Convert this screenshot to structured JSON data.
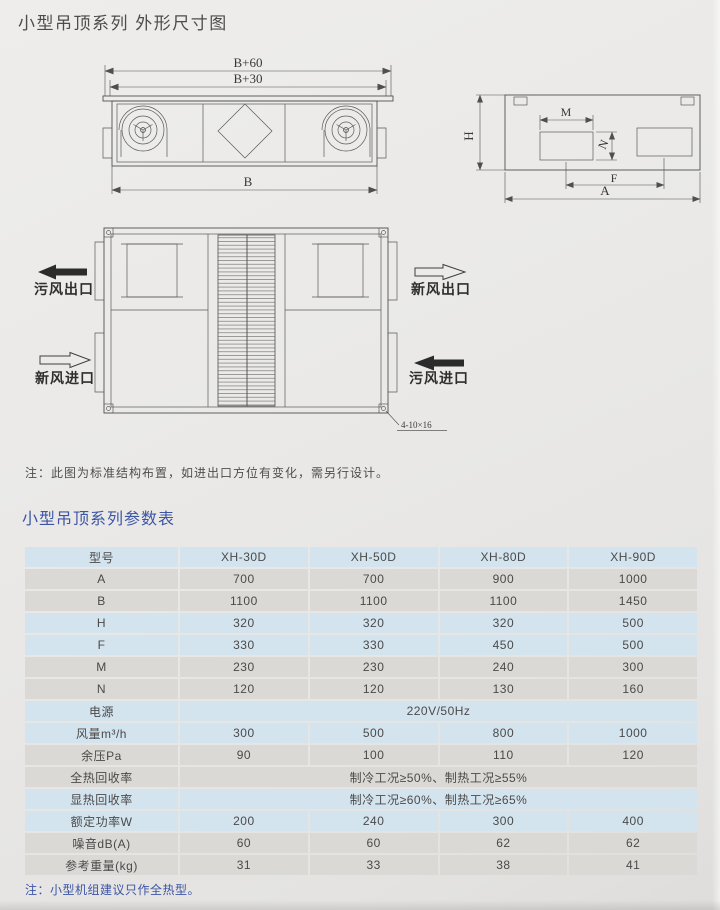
{
  "page": {
    "title": "小型吊顶系列  外形尺寸图",
    "diagram_note": "注：此图为标准结构布置，如进出口方位有变化，需另行设计。",
    "table_title": "小型吊顶系列参数表",
    "table_note": "注：小型机组建议只作全热型。"
  },
  "diagram": {
    "front_view": {
      "dim_top": "B+60",
      "dim_mid": "B+30",
      "dim_bottom": "B"
    },
    "side_view": {
      "dim_h": "H",
      "dim_m": "M",
      "dim_n": "N",
      "dim_f": "F",
      "dim_a": "A"
    },
    "top_view": {
      "exhaust_out": "污风出口",
      "fresh_in": "新风进口",
      "fresh_out": "新风出口",
      "exhaust_in": "污风进口",
      "hole_spec": "4-10×16"
    }
  },
  "table": {
    "header": [
      "型号",
      "XH-30D",
      "XH-50D",
      "XH-80D",
      "XH-90D"
    ],
    "rows": [
      {
        "label": "A",
        "tone": "gray",
        "values": [
          "700",
          "700",
          "900",
          "1000"
        ]
      },
      {
        "label": "B",
        "tone": "gray",
        "values": [
          "1100",
          "1100",
          "1100",
          "1450"
        ]
      },
      {
        "label": "H",
        "tone": "blue",
        "values": [
          "320",
          "320",
          "320",
          "500"
        ]
      },
      {
        "label": "F",
        "tone": "blue",
        "values": [
          "330",
          "330",
          "450",
          "500"
        ]
      },
      {
        "label": "M",
        "tone": "gray",
        "values": [
          "230",
          "230",
          "240",
          "300"
        ]
      },
      {
        "label": "N",
        "tone": "gray",
        "values": [
          "120",
          "120",
          "130",
          "160"
        ]
      },
      {
        "label": "电源",
        "tone": "blue",
        "span": "220V/50Hz"
      },
      {
        "label": "风量m³/h",
        "tone": "blue",
        "values": [
          "300",
          "500",
          "800",
          "1000"
        ]
      },
      {
        "label": "余压Pa",
        "tone": "gray",
        "values": [
          "90",
          "100",
          "110",
          "120"
        ]
      },
      {
        "label": "全热回收率",
        "tone": "gray",
        "span": "制冷工况≥50%、制热工况≥55%"
      },
      {
        "label": "显热回收率",
        "tone": "blue",
        "span": "制冷工况≥60%、制热工况≥65%"
      },
      {
        "label": "额定功率W",
        "tone": "blue",
        "values": [
          "200",
          "240",
          "300",
          "400"
        ]
      },
      {
        "label": "噪音dB(A)",
        "tone": "gray",
        "values": [
          "60",
          "60",
          "62",
          "62"
        ]
      },
      {
        "label": "参考重量(kg)",
        "tone": "gray",
        "values": [
          "31",
          "33",
          "38",
          "41"
        ]
      }
    ]
  },
  "colors": {
    "row_blue": "#d4e4ee",
    "row_gray": "#dbd9d5",
    "accent_blue": "#3c55a5",
    "line": "#515151",
    "page_bg": "#e9e8e6"
  }
}
